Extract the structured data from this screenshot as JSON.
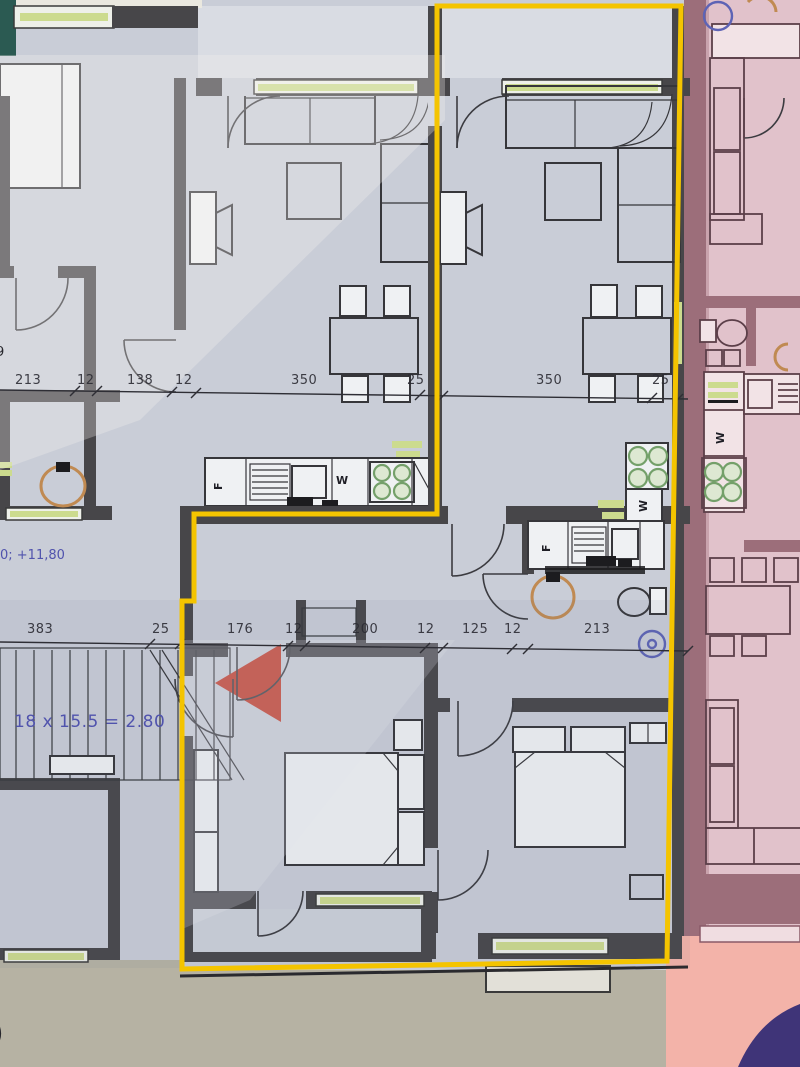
{
  "colors": {
    "paper": "#b6b2a3",
    "floor": "#c9cdd7",
    "wall": "#474649",
    "yellow": "#f4c400",
    "pink": "#e1c2cb",
    "mauve": "#9c6e7a",
    "salmon": "#f3b3a9",
    "teal": "#2b5a52",
    "purple": "#3f3478",
    "red": "#c23a28",
    "green": "#ccdb8e",
    "blue": "#5053ad",
    "ink": "#2e2e35"
  },
  "dim_lines": [
    {
      "name": "upper",
      "label_y": 373,
      "values": [
        {
          "label": "213",
          "x": 15
        },
        {
          "label": "12",
          "x": 77
        },
        {
          "label": "138",
          "x": 127
        },
        {
          "label": "12",
          "x": 175
        },
        {
          "label": "350",
          "x": 291
        },
        {
          "label": "25",
          "x": 407
        },
        {
          "label": "350",
          "x": 536
        },
        {
          "label": "25",
          "x": 652
        }
      ]
    },
    {
      "name": "lower",
      "label_y": 622,
      "values": [
        {
          "label": "383",
          "x": 27
        },
        {
          "label": "25",
          "x": 152
        },
        {
          "label": "176",
          "x": 227
        },
        {
          "label": "12",
          "x": 285
        },
        {
          "label": "200",
          "x": 352
        },
        {
          "label": "12",
          "x": 417
        },
        {
          "label": "125",
          "x": 462
        },
        {
          "label": "12",
          "x": 504
        },
        {
          "label": "213",
          "x": 584
        }
      ]
    }
  ],
  "annotations": {
    "level_note": "0; +11,80",
    "stair_note": "18 x 15.5 = 2.80",
    "left_edge_digit": "9",
    "bottom_left_char": ")"
  },
  "kitchen_labels": [
    {
      "text": "F",
      "x": 212,
      "y": 490,
      "rotate": -90
    },
    {
      "text": "W",
      "x": 336,
      "y": 474,
      "rotate": 0
    },
    {
      "text": "F",
      "x": 540,
      "y": 552,
      "rotate": -90
    },
    {
      "text": "W",
      "x": 637,
      "y": 512,
      "rotate": -90
    },
    {
      "text": "W",
      "x": 714,
      "y": 444,
      "rotate": -90
    }
  ]
}
